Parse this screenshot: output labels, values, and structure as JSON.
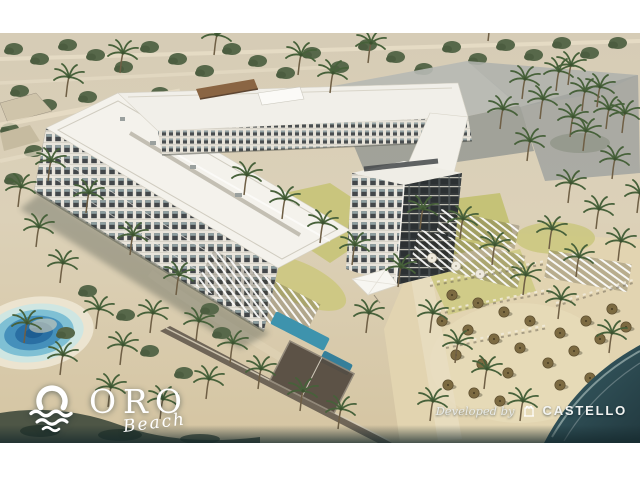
{
  "branding": {
    "project": {
      "name": "ORO",
      "tagline": "Beach",
      "icon": "sun-over-waves-icon"
    },
    "developer": {
      "prefix": "Developed by",
      "name": "CASTELLO",
      "icon": "castle-crest-icon"
    }
  },
  "scene": {
    "type": "aerial-architectural-render",
    "elements": [
      "u-shaped-residential-building",
      "courtyard-pools",
      "pergola-sun-decks",
      "sports-court",
      "beach-with-thatch-umbrellas",
      "sea",
      "lagoon-pool",
      "palm-trees",
      "desert-tree-belt",
      "future-phase-gray-massing"
    ],
    "colors": {
      "frame": "#ffffff",
      "desert_sand": "#d8cdb4",
      "beach_sand": "#e3d5b1",
      "foliage_green": "#55673f",
      "building_white": "#f4f2ec",
      "facade_dark": "#3a3e3c",
      "pool_blue": "#3e93ad",
      "lagoon_blue": "#2a6fa3",
      "sea_teal": "#2b454b",
      "ghost_gray": "#adafaa",
      "lawn_green": "#c6c377"
    }
  }
}
